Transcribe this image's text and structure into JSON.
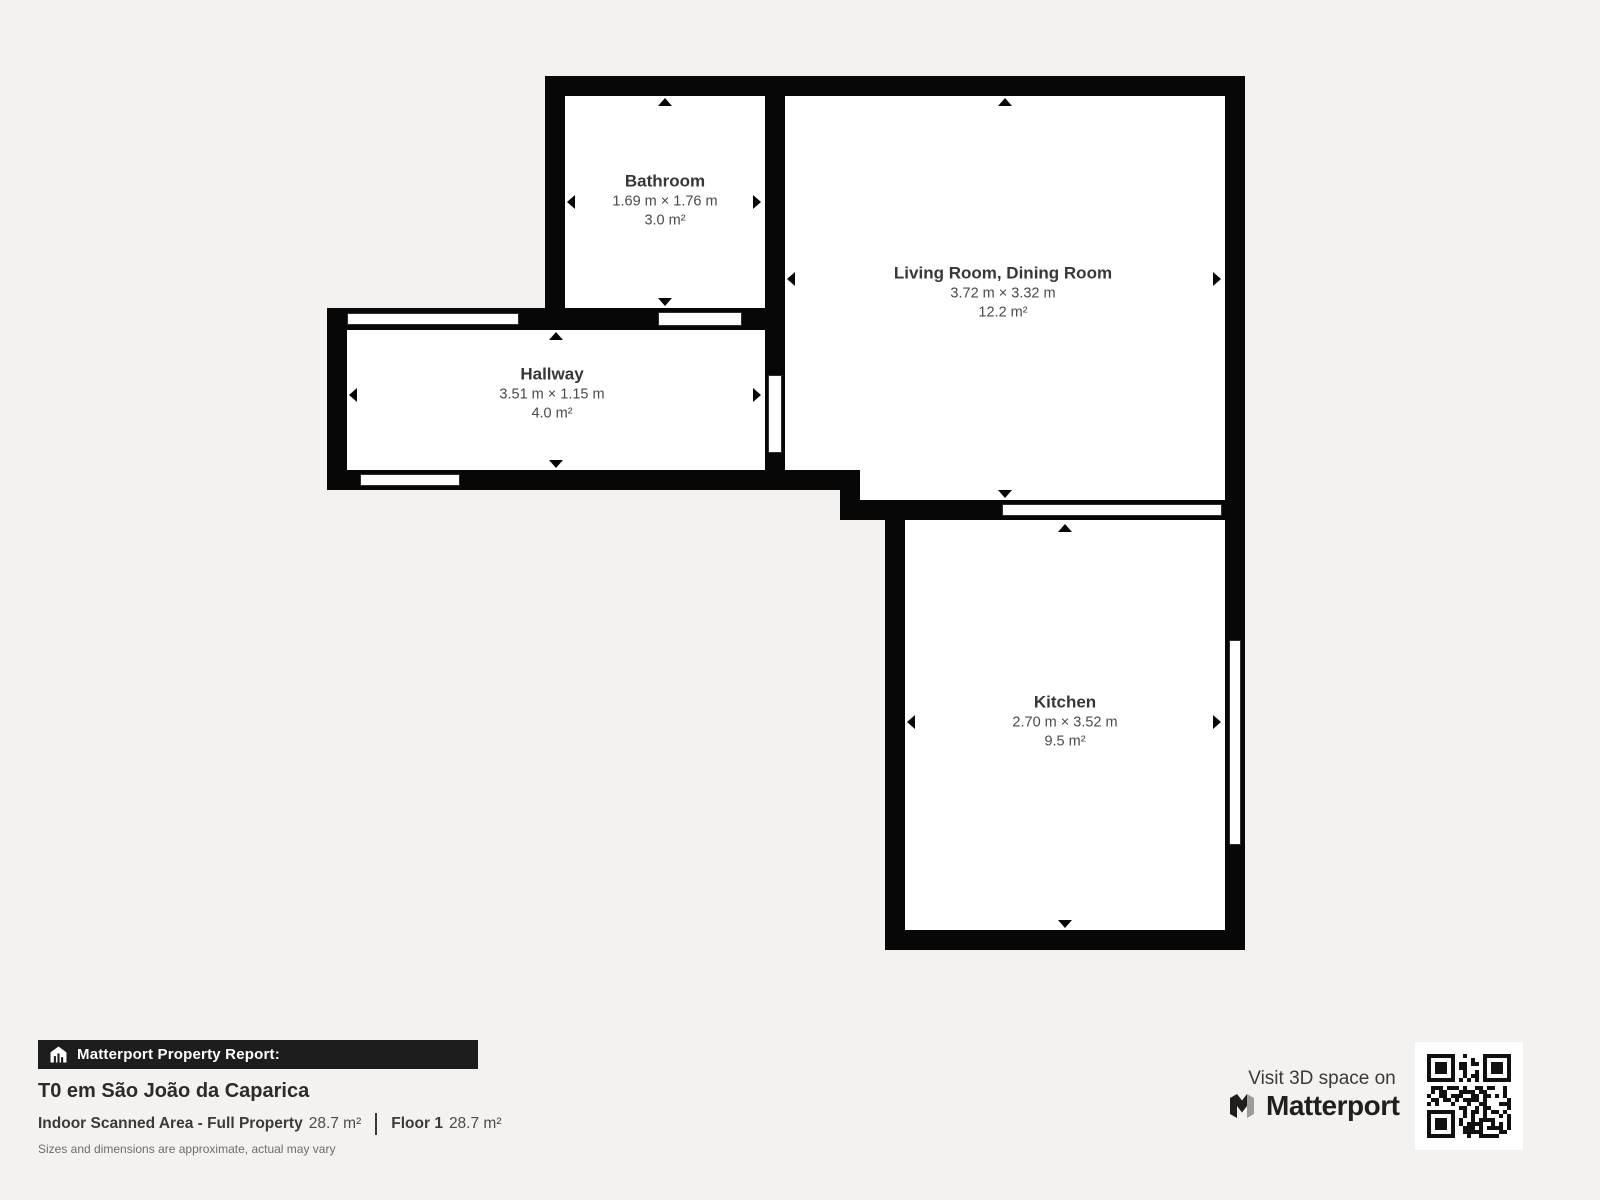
{
  "page": {
    "background_color": "#f3f2f1"
  },
  "floorplan": {
    "wall_color": "#070707",
    "room_fill_color": "#ffffff",
    "rooms": [
      {
        "id": "bathroom",
        "name": "Bathroom",
        "dimensions": "1.69 m × 1.76 m",
        "area": "3.0 m²"
      },
      {
        "id": "living-room",
        "name": "Living Room, Dining Room",
        "dimensions": "3.72 m × 3.32 m",
        "area": "12.2 m²"
      },
      {
        "id": "hallway",
        "name": "Hallway",
        "dimensions": "3.51 m × 1.15 m",
        "area": "4.0 m²"
      },
      {
        "id": "kitchen",
        "name": "Kitchen",
        "dimensions": "2.70 m × 3.52 m",
        "area": "9.5 m²"
      }
    ]
  },
  "report": {
    "badge_label": "Matterport Property Report:",
    "title": "T0 em São João da Caparica",
    "scanned_area_label": "Indoor Scanned Area - Full Property",
    "scanned_area_value": "28.7 m²",
    "floor_label": "Floor 1",
    "floor_value": "28.7 m²",
    "disclaimer": "Sizes and dimensions are approximate, actual may vary"
  },
  "branding": {
    "visit_text": "Visit 3D space on",
    "brand_name": "Matterport"
  },
  "icons": {
    "house_icon": "house-with-bars",
    "matterport_logo": "folded-m-mark",
    "qr_code": "scan-to-visit-3d-space"
  }
}
